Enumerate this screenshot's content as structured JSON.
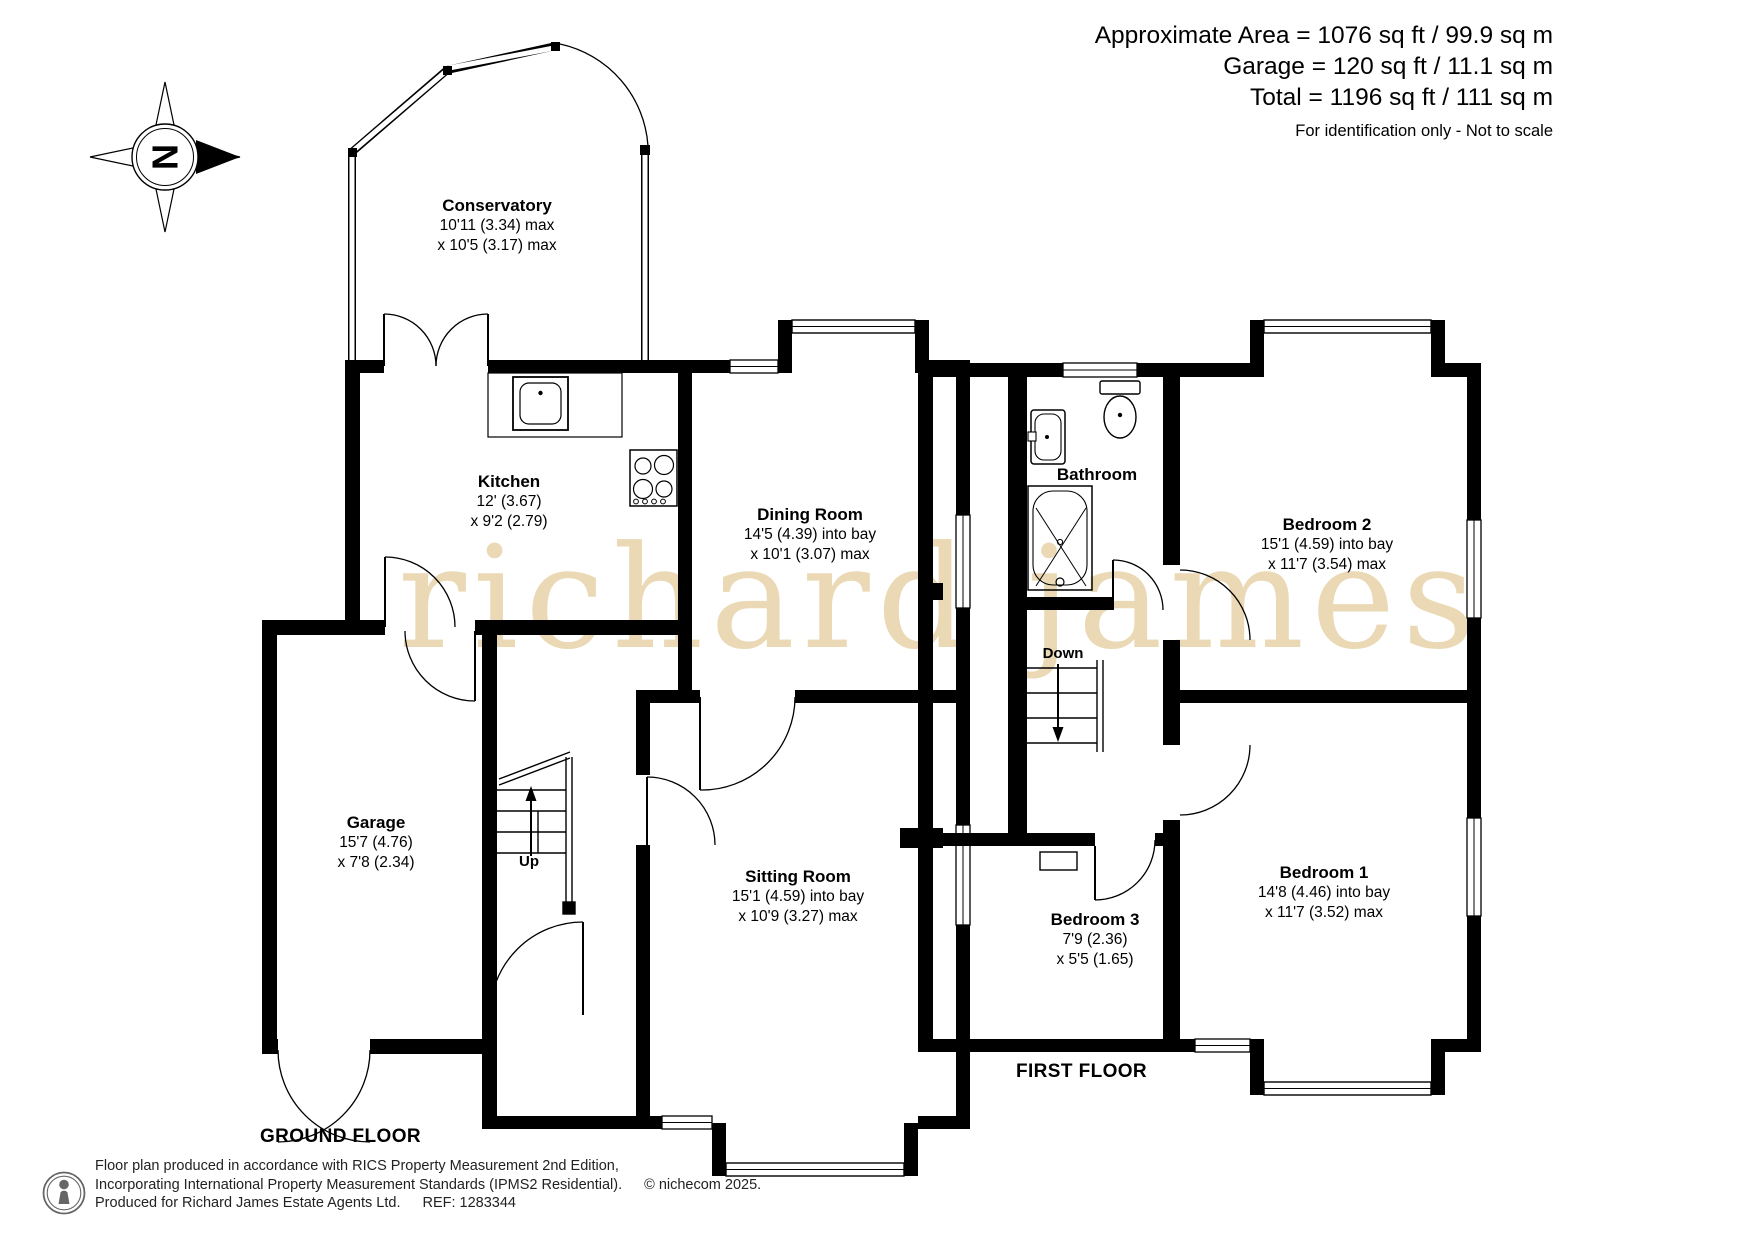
{
  "header": {
    "area_line": "Approximate Area = 1076 sq ft / 99.9 sq m",
    "garage_line": "Garage = 120 sq ft / 11.1 sq m",
    "total_line": "Total = 1196 sq ft / 111 sq m",
    "disclaimer": "For identification only - Not to scale"
  },
  "compass": {
    "label": "N"
  },
  "watermark": "richard james",
  "floors": {
    "ground": {
      "caption": "GROUND FLOOR",
      "stairs_label": "Up",
      "rooms": {
        "conservatory": {
          "name": "Conservatory",
          "dim1": "10'11 (3.34) max",
          "dim2": "x 10'5 (3.17) max"
        },
        "kitchen": {
          "name": "Kitchen",
          "dim1": "12' (3.67)",
          "dim2": "x 9'2 (2.79)"
        },
        "dining": {
          "name": "Dining Room",
          "dim1": "14'5 (4.39) into bay",
          "dim2": "x 10'1 (3.07) max"
        },
        "sitting": {
          "name": "Sitting Room",
          "dim1": "15'1 (4.59) into bay",
          "dim2": "x 10'9 (3.27) max"
        },
        "garage": {
          "name": "Garage",
          "dim1": "15'7 (4.76)",
          "dim2": "x 7'8 (2.34)"
        }
      }
    },
    "first": {
      "caption": "FIRST FLOOR",
      "stairs_label": "Down",
      "rooms": {
        "bathroom": {
          "name": "Bathroom"
        },
        "bedroom2": {
          "name": "Bedroom 2",
          "dim1": "15'1 (4.59) into bay",
          "dim2": "x 11'7 (3.54) max"
        },
        "bedroom1": {
          "name": "Bedroom 1",
          "dim1": "14'8 (4.46) into bay",
          "dim2": "x 11'7 (3.52) max"
        },
        "bedroom3": {
          "name": "Bedroom 3",
          "dim1": "7'9 (2.36)",
          "dim2": "x 5'5 (1.65)"
        }
      }
    }
  },
  "footer": {
    "line1": "Floor plan produced in accordance with RICS Property Measurement 2nd Edition,",
    "line2": "Incorporating International Property Measurement Standards (IPMS2 Residential).",
    "copyright": "© nichecom 2025.",
    "line3": "Produced for Richard James Estate Agents Ltd.",
    "ref": "REF: 1283344"
  },
  "colors": {
    "wall": "#000000",
    "watermark": "#ead9b4"
  }
}
